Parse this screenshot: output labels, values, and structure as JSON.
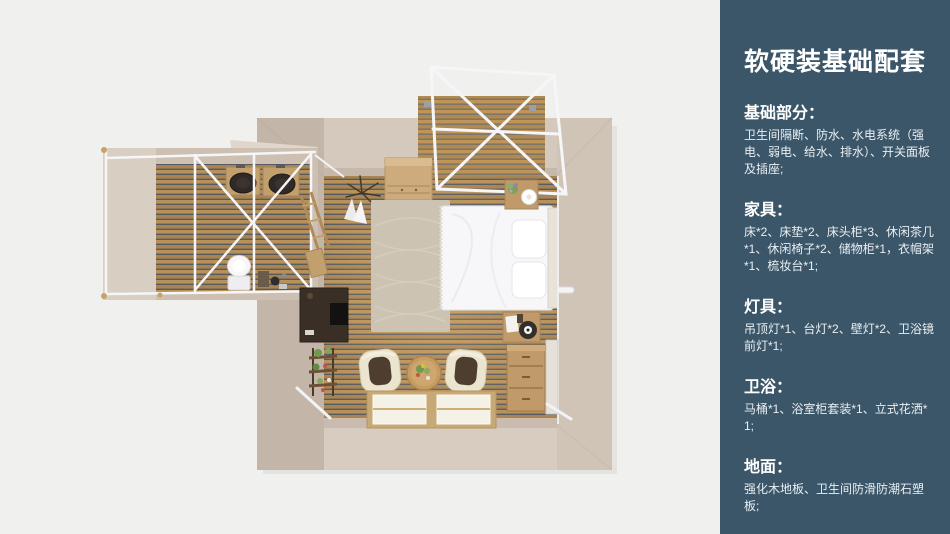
{
  "panel": {
    "title": "软硬装基础配套",
    "sections": [
      {
        "heading": "基础部分：",
        "body": "卫生间隔断、防水、水电系统（强电、弱电、给水、排水）、开关面板及插座;"
      },
      {
        "heading": "家具：",
        "body": "床*2、床垫*2、床头柜*3、休闲茶几*1、休闲椅子*2、储物柜*1，衣帽架*1、梳妆台*1;"
      },
      {
        "heading": "灯具：",
        "body": "吊顶灯*1、台灯*2、壁灯*2、卫浴镜前灯*1;"
      },
      {
        "heading": "卫浴：",
        "body": "马桶*1、浴室柜套装*1、立式花洒*1;"
      },
      {
        "heading": "地面：",
        "body": "强化木地板、卫生间防滑防潮石塑板;"
      }
    ]
  },
  "floorplan": {
    "caption": "俯视渲染图：主卧室带左侧卫生间隔断及顶部露台",
    "items": [
      "deck-pergola",
      "bathroom-annex",
      "double-vanity-sinks",
      "toilet",
      "wardrobe",
      "clothes-rack",
      "rug",
      "bed",
      "nightstand-top",
      "nightstand-bottom",
      "wall-lamp",
      "desk-tv-stand",
      "plant-stand",
      "armchair-left",
      "armchair-right",
      "tea-table",
      "floor-windows",
      "dresser",
      "mirror-panel"
    ]
  },
  "colors": {
    "page_bg": "#f0f0ef",
    "panel_bg": "#3b5668",
    "wall": "#cfc3b6",
    "wall_light": "#d8cdc0",
    "wall_dark": "#c1b4a7",
    "floor_slat": "#b8905a",
    "floor_gap": "#565b62",
    "frame_white": "#f6f6f8",
    "bed_white": "#f7f7f9",
    "rug": "#cdc3b3",
    "furniture_wood": "#c09a69",
    "desk_dark": "#3a2f26",
    "chair_cream": "#ebe4cf",
    "cushion_brown": "#4d3e2f",
    "sink_dark": "#2f2a28"
  }
}
